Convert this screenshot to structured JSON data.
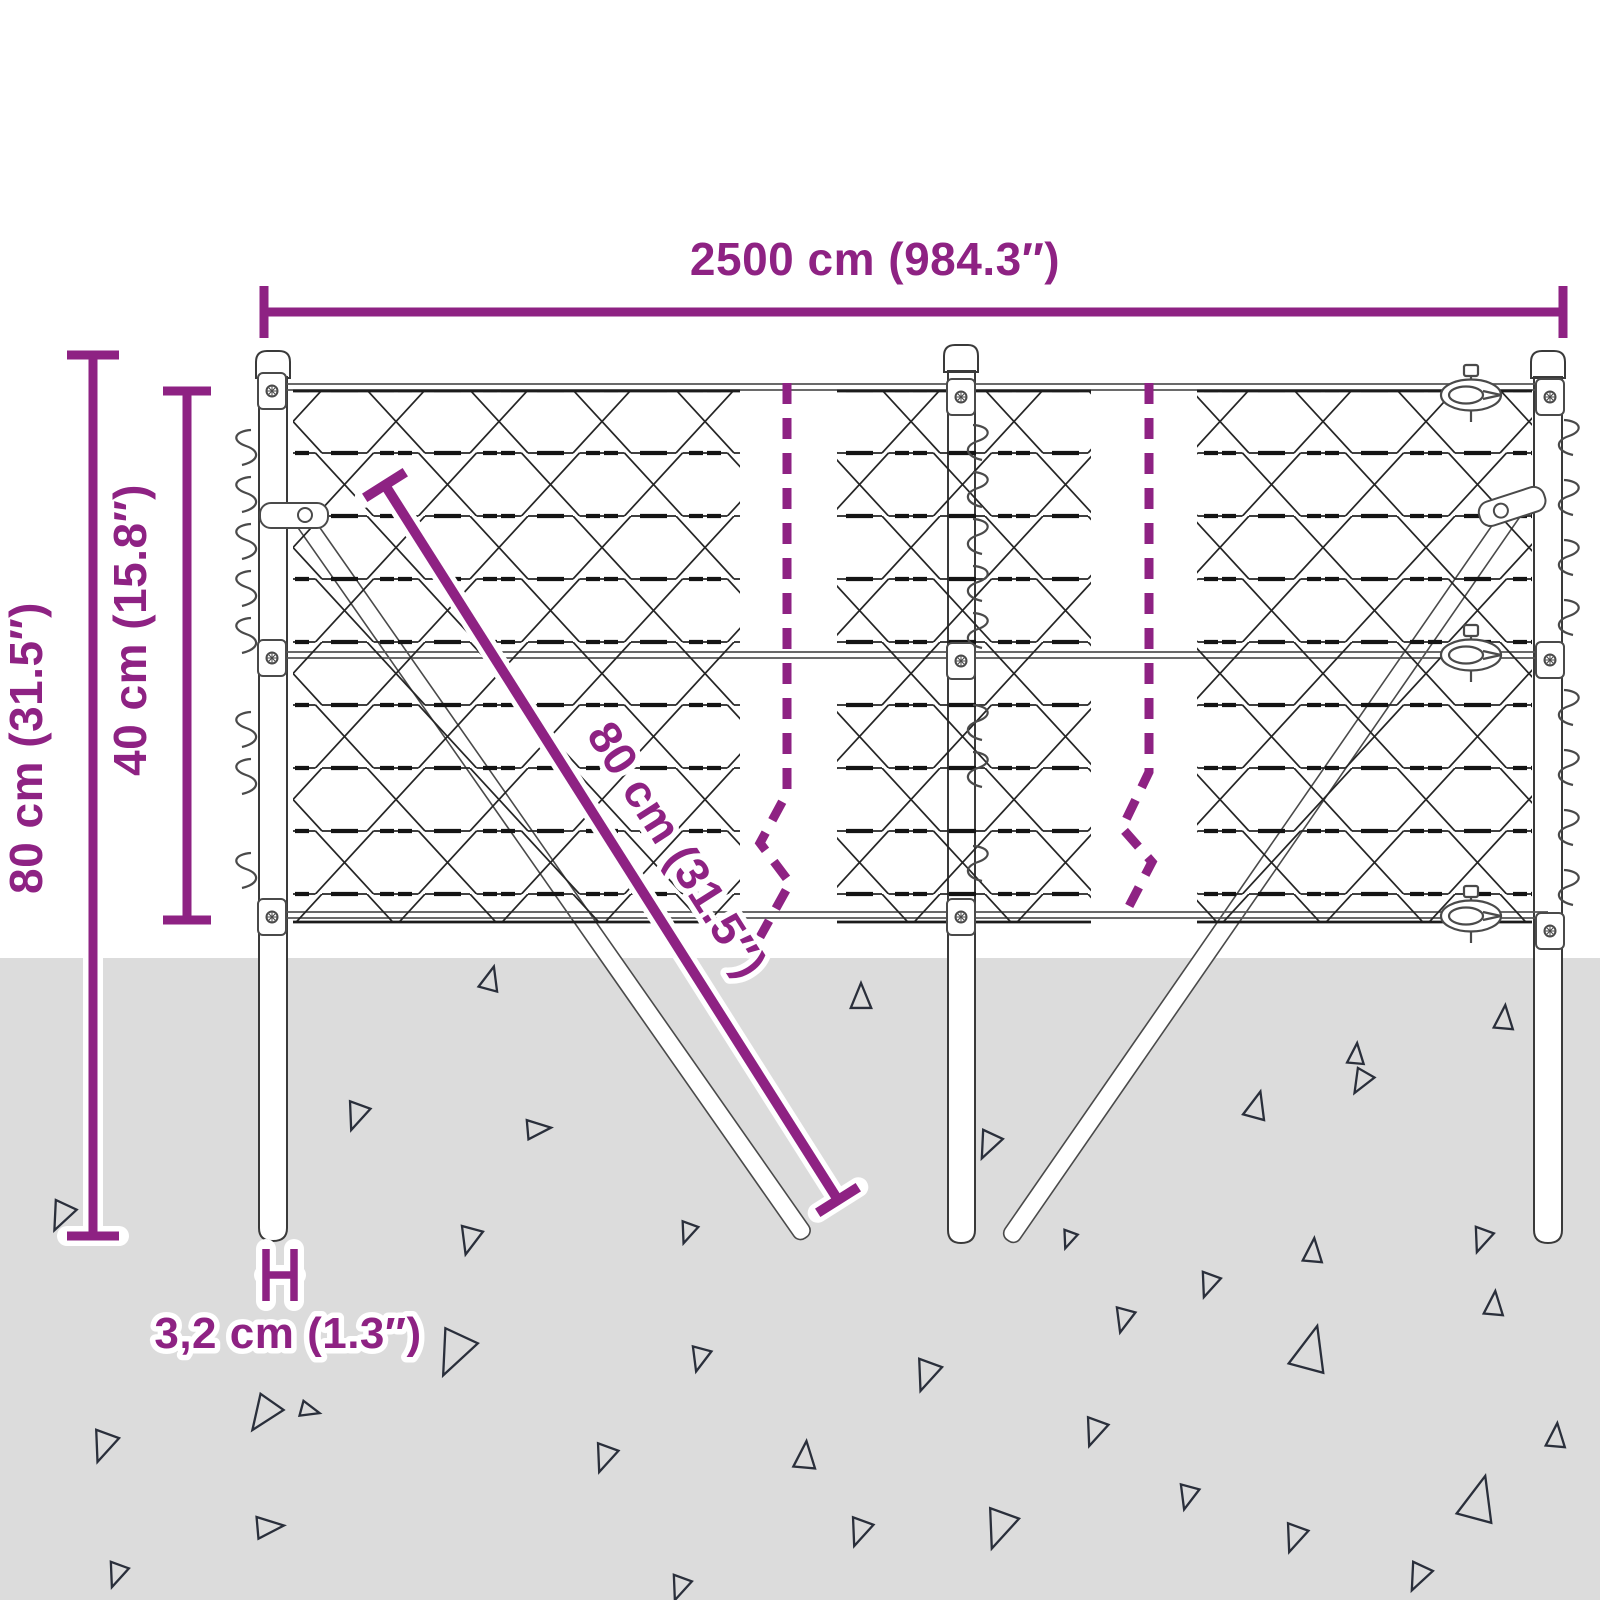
{
  "diagram": {
    "type": "product-dimension-drawing",
    "subject": "chain-link fence with posts, braces and ground anchoring",
    "labels": {
      "top_width": "2500 cm (984.3″)",
      "left_total_height": "80 cm (31.5″)",
      "left_inner_height": "40 cm (15.8″)",
      "diagonal_brace": "80 cm (31.5″)",
      "post_diameter": "3,2 cm (1.3″)"
    },
    "colors": {
      "dimension_accent": "#8E2283",
      "ground": "#DCDCDC",
      "drawing_outline": "#3A3A3A",
      "mesh_line": "#262626",
      "soil_triangle": "#2A2F3B"
    },
    "ground": {
      "triangles": [
        {
          "x": 490,
          "y": 981,
          "s": 15,
          "r": 15
        },
        {
          "x": 861,
          "y": 999,
          "s": 16,
          "r": 0
        },
        {
          "x": 62,
          "y": 1214,
          "s": 18,
          "r": 205
        },
        {
          "x": 357,
          "y": 1114,
          "s": 17,
          "r": 200
        },
        {
          "x": 536,
          "y": 1129,
          "s": 15,
          "r": 85
        },
        {
          "x": 470,
          "y": 1238,
          "s": 17,
          "r": 195
        },
        {
          "x": 688,
          "y": 1231,
          "s": 13,
          "r": 200
        },
        {
          "x": 265,
          "y": 1412,
          "s": 22,
          "r": 215
        },
        {
          "x": 455,
          "y": 1350,
          "s": 28,
          "r": 205
        },
        {
          "x": 104,
          "y": 1444,
          "s": 19,
          "r": 200
        },
        {
          "x": 308,
          "y": 1410,
          "s": 12,
          "r": 105
        },
        {
          "x": 117,
          "y": 1573,
          "s": 15,
          "r": 200
        },
        {
          "x": 267,
          "y": 1527,
          "s": 17,
          "r": 85
        },
        {
          "x": 605,
          "y": 1456,
          "s": 17,
          "r": 200
        },
        {
          "x": 680,
          "y": 1586,
          "s": 15,
          "r": 200
        },
        {
          "x": 700,
          "y": 1357,
          "s": 15,
          "r": 195
        },
        {
          "x": 1356,
          "y": 1056,
          "s": 13,
          "r": 5
        },
        {
          "x": 1504,
          "y": 1020,
          "s": 15,
          "r": 5
        },
        {
          "x": 1362,
          "y": 1080,
          "s": 15,
          "r": 210
        },
        {
          "x": 1256,
          "y": 1108,
          "s": 17,
          "r": 15
        },
        {
          "x": 989,
          "y": 1143,
          "s": 17,
          "r": 205
        },
        {
          "x": 1069,
          "y": 1238,
          "s": 11,
          "r": 200
        },
        {
          "x": 1313,
          "y": 1253,
          "s": 15,
          "r": 5
        },
        {
          "x": 1209,
          "y": 1283,
          "s": 15,
          "r": 200
        },
        {
          "x": 1482,
          "y": 1238,
          "s": 15,
          "r": 200
        },
        {
          "x": 1494,
          "y": 1306,
          "s": 15,
          "r": 5
        },
        {
          "x": 1124,
          "y": 1318,
          "s": 15,
          "r": 195
        },
        {
          "x": 927,
          "y": 1373,
          "s": 19,
          "r": 200
        },
        {
          "x": 1310,
          "y": 1353,
          "s": 28,
          "r": 15
        },
        {
          "x": 805,
          "y": 1458,
          "s": 17,
          "r": 5
        },
        {
          "x": 1095,
          "y": 1430,
          "s": 17,
          "r": 200
        },
        {
          "x": 1556,
          "y": 1438,
          "s": 15,
          "r": 5
        },
        {
          "x": 1188,
          "y": 1495,
          "s": 15,
          "r": 195
        },
        {
          "x": 1478,
          "y": 1503,
          "s": 28,
          "r": 15
        },
        {
          "x": 860,
          "y": 1530,
          "s": 17,
          "r": 200
        },
        {
          "x": 1000,
          "y": 1526,
          "s": 24,
          "r": 200
        },
        {
          "x": 1295,
          "y": 1536,
          "s": 17,
          "r": 200
        },
        {
          "x": 1419,
          "y": 1575,
          "s": 17,
          "r": 205
        }
      ]
    }
  }
}
